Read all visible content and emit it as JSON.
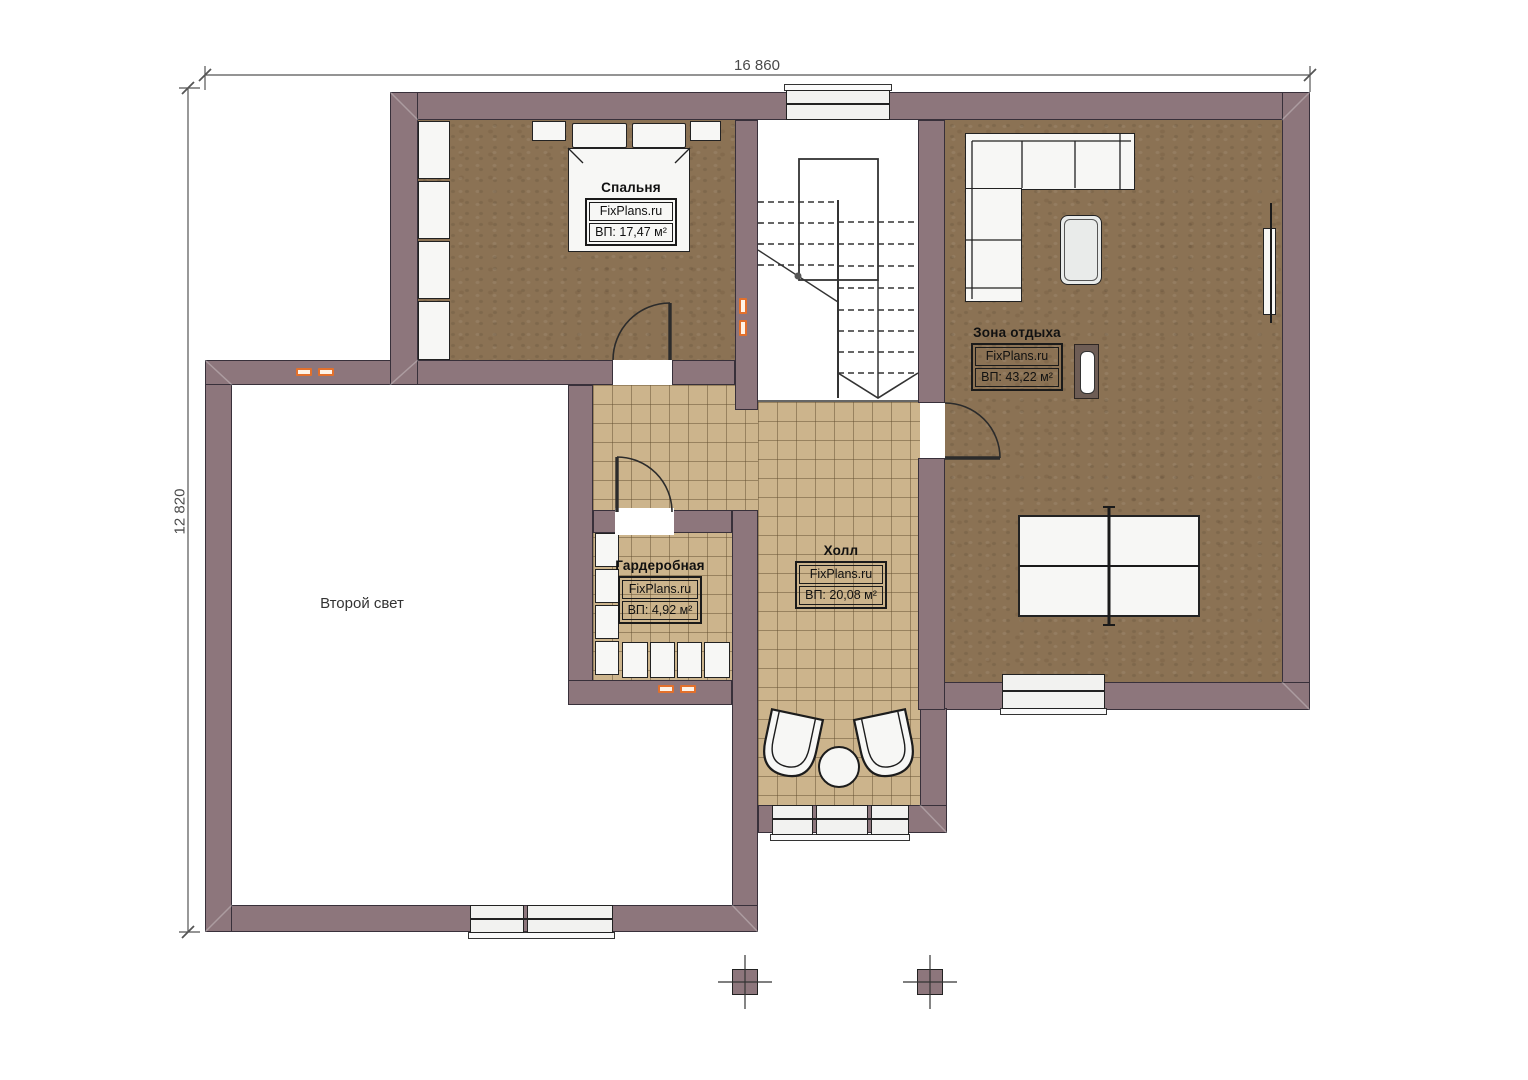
{
  "brand": "FixPlans.ru",
  "dimensions": {
    "width_label": "16 860",
    "height_label": "12 820"
  },
  "rooms": [
    {
      "name": "Спальня",
      "area_label": "ВП: 17,47 м²"
    },
    {
      "name": "Зона отдыха",
      "area_label": "ВП: 43,22 м²"
    },
    {
      "name": "Гардеробная",
      "area_label": "ВП: 4,92 м²"
    },
    {
      "name": "Холл",
      "area_label": "ВП: 20,08 м²"
    },
    {
      "name": "Второй свет"
    }
  ],
  "colors": {
    "wall": "#8d767c",
    "floor_carpet": "#8b7254",
    "floor_tile": "#ccb48c",
    "accent": "#e2702c"
  }
}
